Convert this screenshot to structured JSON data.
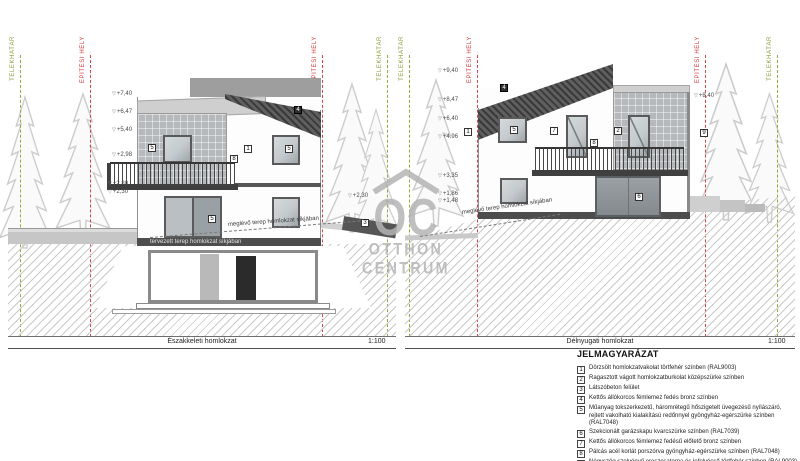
{
  "panels": [
    {
      "title": "Északkeleti homlokzat",
      "scale": "1:100",
      "boundaries": [
        "TELEKHATÁR",
        "ÉPÍTÉSI HELY",
        "ÉPÍTÉSI HELY",
        "TELEKHATÁR"
      ],
      "markers_left": [
        "+7,40",
        "+6,47",
        "+5,40",
        "+2,98",
        "+2,80",
        "+2,30"
      ],
      "markers_right": [
        "+2,30"
      ],
      "terrain_note": "meglévő terep homlokzat síkjában",
      "plinth_note": "tervezett terep homlokzat síkjában",
      "callouts": [
        "5",
        "1",
        "5",
        "8",
        "4",
        "5",
        "3"
      ]
    },
    {
      "title": "Délnyugati homlokzat",
      "scale": "1:100",
      "boundaries": [
        "TELEKHATÁR",
        "ÉPÍTÉSI HELY",
        "ÉPÍTÉSI HELY",
        "TELEKHATÁR"
      ],
      "markers_left": [
        "+9,40",
        "+8,47",
        "+6,40",
        "+4,96",
        "+3,35",
        "+1,86",
        "+1,48"
      ],
      "markers_right": [
        "+8,40"
      ],
      "terrain_note": "meglévő terep homlokzat síkjában",
      "callouts": [
        "4",
        "1",
        "5",
        "7",
        "2",
        "8",
        "9",
        "6"
      ]
    }
  ],
  "watermark": {
    "monogram": "OC",
    "line1": "OTTHON",
    "line2": "CENTRUM"
  },
  "legend": {
    "title": "JELMAGYARÁZAT",
    "items": [
      {
        "num": "1",
        "text": "Dörzsölt homlokzatvakolat törtfehér színben (RAL9003)"
      },
      {
        "num": "2",
        "text": "Ragasztott vágott homlokzatburkolat középszürke színben"
      },
      {
        "num": "3",
        "text": "Látszóbeton felület"
      },
      {
        "num": "4",
        "text": "Kettős állókorcos fémlemez fedés bronz színben"
      },
      {
        "num": "5",
        "text": "Műanyag tokszerkezetű, háromrétegű hőszigetelt üvegezésű nyílászáró, rejtett vakolható kialakítású redőnnyel gyöngyház-egérszürke színben (RAL7048)"
      },
      {
        "num": "6",
        "text": "Szekcionált garázskapu kvarcszürke színben (RAL7039)"
      },
      {
        "num": "7",
        "text": "Kettős állókorcos fémlemez fedésű előtető bronz színben"
      },
      {
        "num": "8",
        "text": "Pálcás acél korlát porszórva gyöngyház-egérszürke színben (RAL7048)"
      },
      {
        "num": "9",
        "text": "Négyszög szelvényű ereszcsatorna és lefolyócső törtfehér színben (RAL9003)"
      }
    ]
  },
  "colors": {
    "boundary_green": "#8a9a33",
    "boundary_red": "#cc3a3a",
    "roof_dark": "#4a4a4a",
    "tile_gray": "#b6b9bb",
    "watermark_gray": "#b4b4b4",
    "hatch_gray": "#c9c9c9"
  }
}
